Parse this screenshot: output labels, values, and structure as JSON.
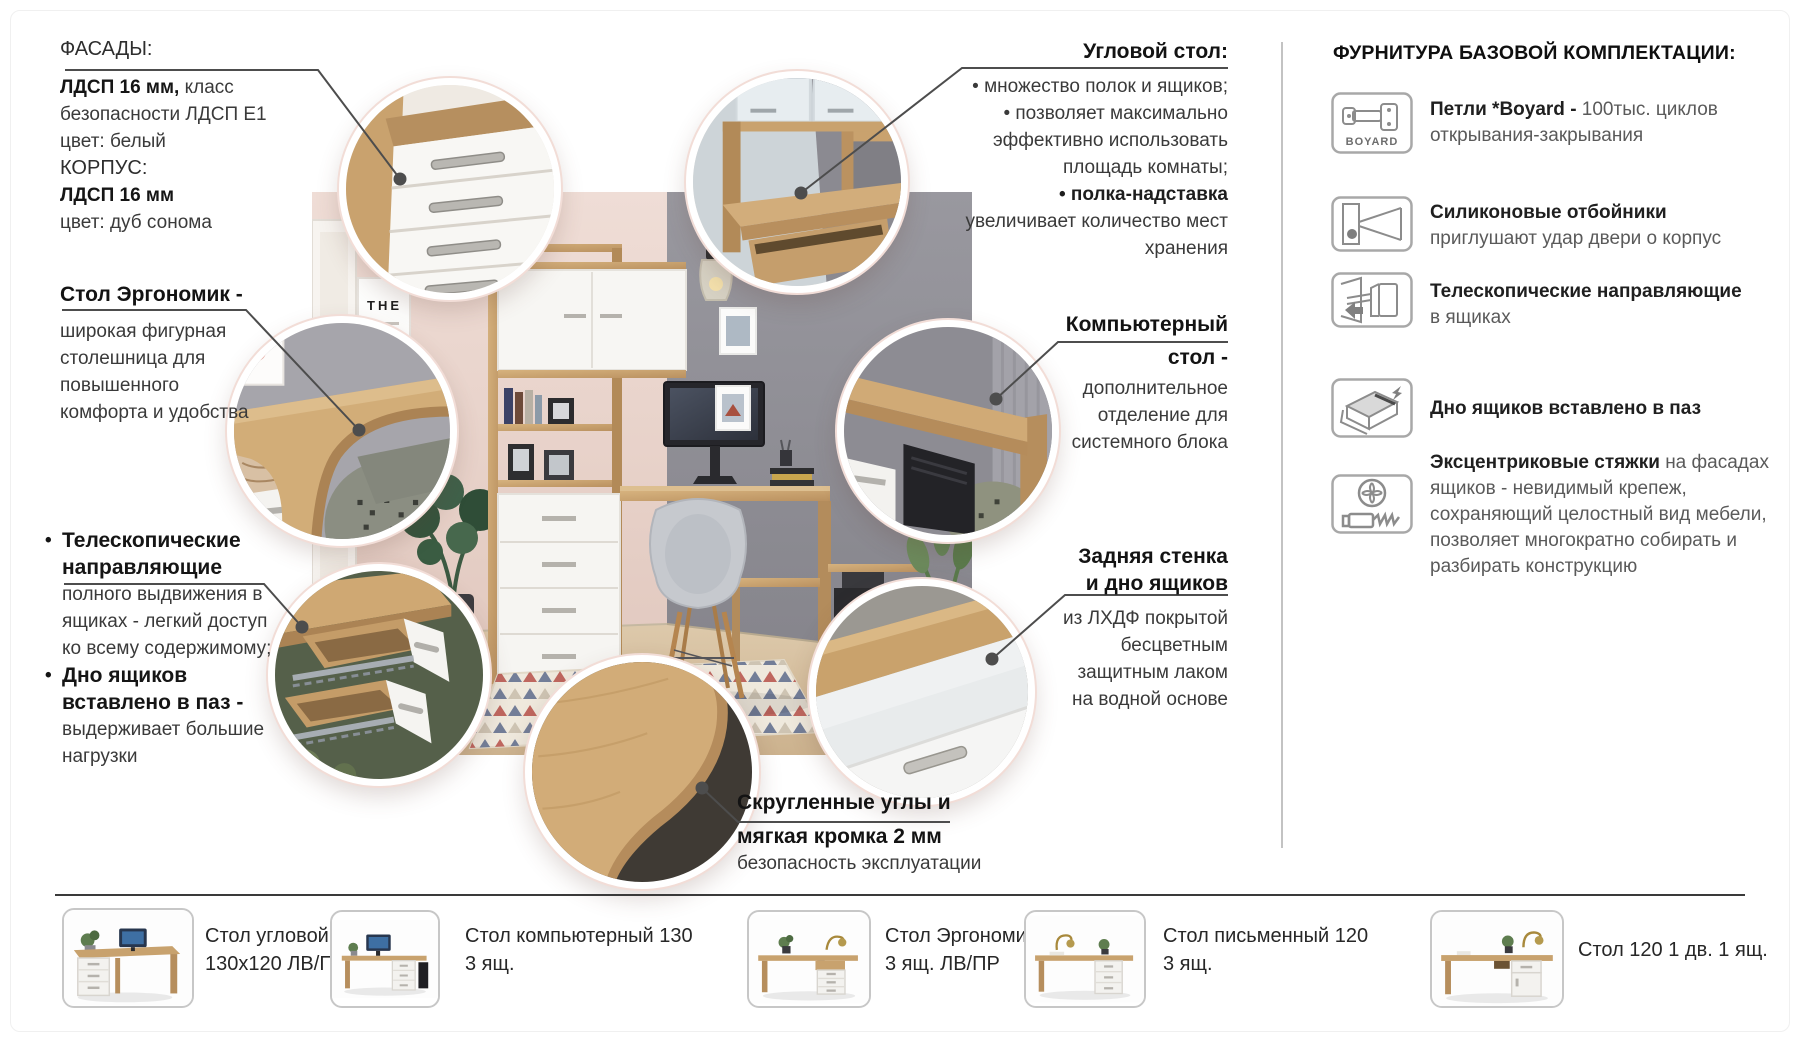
{
  "page": {
    "poster_text": "THE"
  },
  "ui": {
    "bullet": "•"
  },
  "colors": {
    "wood": "#c8a26e",
    "wood_dark": "#ab8354",
    "white_furniture": "#f6f5f2",
    "wall_gray": "#8e8d94",
    "wall_pink": "#ead6cf",
    "callout_line": "#4d4d4d",
    "text_dark": "#151515",
    "rug_red": "#b65049",
    "rug_blue": "#5d6b8c"
  },
  "callouts": {
    "facades": {
      "title": "ФАСАДЫ:",
      "l1b": "ЛДСП 16 мм,",
      "l1r": "класс безопасности ЛДСП Е1",
      "l3": "цвет: белый",
      "l4": "КОРПУС:",
      "l5b": "ЛДСП 16 мм",
      "l6": "цвет: дуб сонома"
    },
    "corner_desk": {
      "title": "Угловой стол:",
      "b1": "• множество полок и ящиков;",
      "b2": "• позволяет максимально эффективно использовать площадь комнаты;",
      "b3b": "• полка-надставка",
      "b3r": "увеличивает количество мест хранения"
    },
    "ergonomic": {
      "title": "Стол Эргономик -",
      "body": "широкая фигурная столешница для повышенного комфорта и удобства"
    },
    "computer_desk": {
      "title1": "Компьютерный",
      "title2": "стол -",
      "body": "дополнительное отделение для системного блока"
    },
    "telescopic": {
      "b1b": "Телескопические направляющие",
      "b1r": "полного выдвижения в ящиках - легкий доступ ко всему содержимому;",
      "b2b": "Дно ящиков вставлено в паз -",
      "b2r": "выдерживает большие нагрузки"
    },
    "back_wall": {
      "title1": "Задняя стенка",
      "title2": "и дно ящиков",
      "body": "из ЛХДФ покрытой бесцветным защитным лаком на водной основе"
    },
    "rounded": {
      "title1": "Скругленные углы и",
      "title2": "мягкая кромка 2 мм",
      "body": "безопасность эксплуатации"
    }
  },
  "hardware": {
    "title": "ФУРНИТУРА БАЗОВОЙ КОМПЛЕКТАЦИИ:",
    "items": [
      {
        "icon": "hinge-boyard-icon",
        "brand": "BOYARD",
        "bold": "Петли *Boyard - ",
        "rest": "100тыс. циклов открывания-закрывания"
      },
      {
        "icon": "silicone-bumper-icon",
        "bold": "Силиконовые отбойники",
        "rest": "приглушают удар двери о корпус"
      },
      {
        "icon": "telescopic-slides-icon",
        "bold": "Телескопические направляющие",
        "rest": "в ящиках"
      },
      {
        "icon": "drawer-bottom-groove-icon",
        "bold": "Дно ящиков вставлено в паз",
        "rest": ""
      },
      {
        "icon": "eccentric-cam-icon",
        "bold": "Эксцентриковые стяжки",
        "rest": "на фасадах ящиков - невидимый крепеж, сохраняющий целостный вид мебели, позволяет многократно собирать и разбирать конструкцию"
      }
    ]
  },
  "products": [
    {
      "line1": "Стол угловой",
      "line2": "130х120 ЛВ/ПР"
    },
    {
      "line1": "Стол компьютерный 130",
      "line2": "3 ящ."
    },
    {
      "line1": "Стол Эргономик",
      "line2": "3 ящ. ЛВ/ПР"
    },
    {
      "line1": "Стол письменный 120",
      "line2": "3 ящ."
    },
    {
      "line1": "Стол 120 1 дв. 1 ящ.",
      "line2": ""
    }
  ]
}
